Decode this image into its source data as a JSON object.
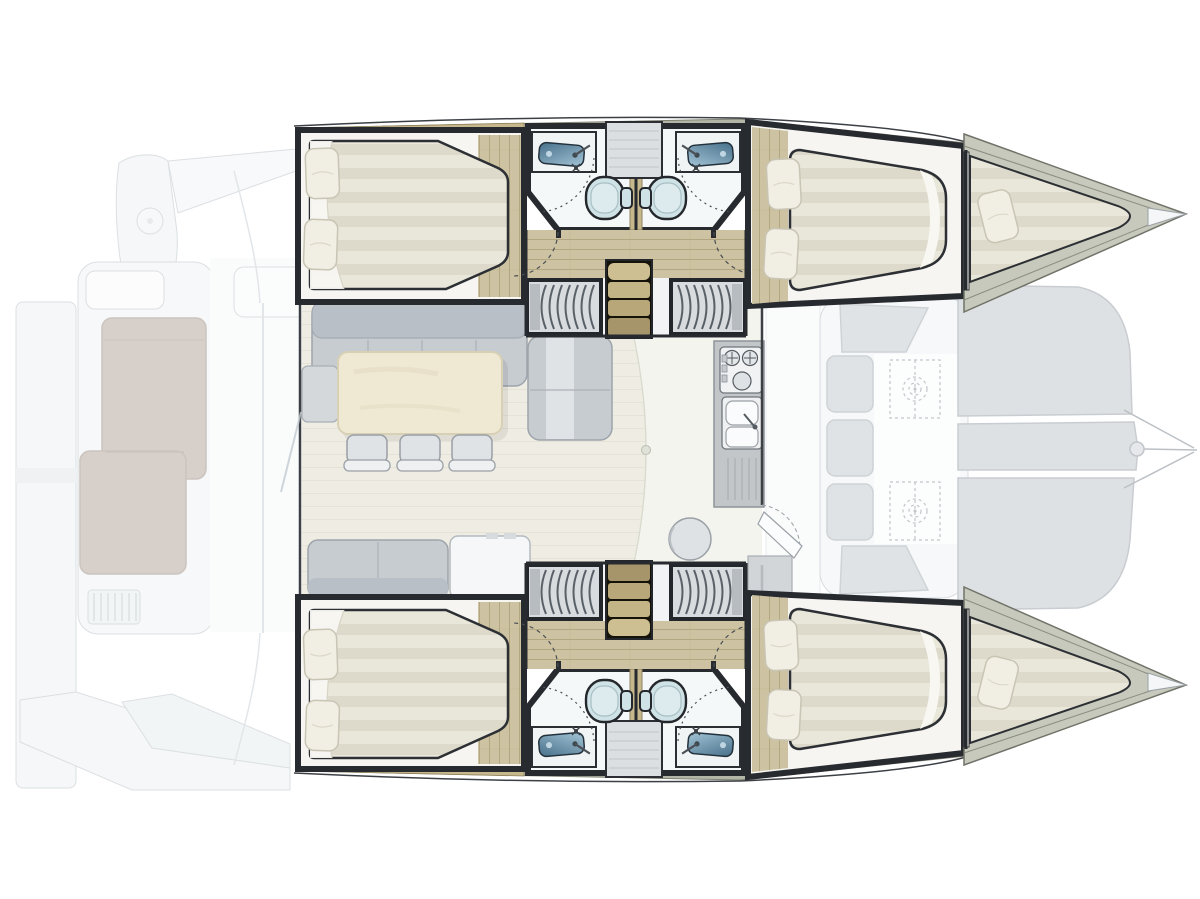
{
  "diagram": {
    "kind": "catamaran-interior-floor-plan",
    "orientation": {
      "bow": "right",
      "stern": "left",
      "port_hull": "top",
      "starboard_hull": "bottom"
    },
    "exterior": {
      "aft_deck_features": [
        "swim-platform",
        "transom-steps",
        "cockpit-lounge-l-sofa",
        "cockpit-bench",
        "deck-grille",
        "round-deck-fitting",
        "side-walkways",
        "sliding-door-track"
      ],
      "foredeck_features": [
        "forward-cockpit-bench",
        "seat-cushions",
        "deck-hatches-dashed",
        "trampoline-panels",
        "bowsprit-bridle-lines",
        "bridle-pin"
      ],
      "trampoline_panel_count": 3,
      "deck_hatch_count": 2
    },
    "port_hull": {
      "rooms": [
        {
          "name": "aft-cabin",
          "fixtures": [
            "double-berth",
            "pillow",
            "pillow",
            "sheet-fold",
            "wood-floor"
          ]
        },
        {
          "name": "aft-head",
          "fixtures": [
            "washbasin",
            "faucet",
            "toilet",
            "shower-door-arc",
            "shower-symbol"
          ]
        },
        {
          "name": "forward-head",
          "fixtures": [
            "washbasin",
            "faucet",
            "toilet",
            "shower-door-arc",
            "shower-symbol"
          ]
        },
        {
          "name": "vanity-cabinet",
          "fixtures": [
            "shelf-cabinet"
          ]
        },
        {
          "name": "companionway",
          "fixtures": [
            "stairs-4-steps",
            "hanging-locker-aft",
            "hanging-locker-forward",
            "door-swing-arc",
            "door-swing-arc"
          ]
        },
        {
          "name": "forward-cabin",
          "fixtures": [
            "double-berth",
            "pillow",
            "pillow",
            "wood-floor"
          ]
        },
        {
          "name": "forepeak",
          "fixtures": [
            "crew-berth",
            "pillow",
            "bow-deck",
            "bow-tip"
          ]
        }
      ]
    },
    "starboard_hull": {
      "mirror_of": "port_hull"
    },
    "salon": {
      "fixtures": [
        "l-shaped-sofa",
        "throw-blanket",
        "side-table",
        "dining-table",
        "dining-chair",
        "dining-chair",
        "dining-chair",
        "bench-seat",
        "storage-cabinet",
        "galley-counter",
        "stove-2-burner",
        "stove-knobs",
        "double-sink",
        "faucet",
        "drainboard",
        "round-stool",
        "foredeck-door-leaf",
        "aft-sliding-door",
        "roof-arc-line",
        "door-knob"
      ]
    },
    "counts": {
      "cabins": 4,
      "heads": 4,
      "forepeak_berths": 2,
      "dining_chairs": 3,
      "toilets": 4,
      "washbasins": 4,
      "hanging_lockers": 4,
      "stairways": 2
    }
  },
  "colors": {
    "paper": "#ffffff",
    "fade_fill": "#eef1f3",
    "fade_fill_2": "#e3e7ea",
    "fade_stroke": "#bfc7cd",
    "cushion": "#cdd2d7",
    "cushion_edge": "#aeb6bc",
    "taupe_sofa": "#b7a89f",
    "taupe_edge": "#a3948c",
    "trampoline": "#c9ced3",
    "trampoline_edge": "#a6adb3",
    "wall_dark": "#272a2f",
    "deck_band": "#b3b5a6",
    "deck_band_edge": "#7e8173",
    "wood_floor": "#cdc3a2",
    "wood_line": "#b2a781",
    "wood_trim": "#c6b88c",
    "bed_platform": "#f6f5f1",
    "mattress": "#e9e6da",
    "mattress_stripe": "#dedacb",
    "mattress_edge": "#2c2f33",
    "pillow": "#f1eee3",
    "pillow_edge": "#c9c5b4",
    "bath_floor": "#f5f8f9",
    "counter_white": "#f1f4f5",
    "sink_blue_deep": "#47708a",
    "sink_blue_light": "#a3c4d6",
    "toilet": "#cfe2e6",
    "locker_body": "#d8dcdf",
    "locker_stripe": "#596067",
    "stair_wood": "#c9ba8d",
    "stair_dark": "#151209",
    "salon_floor": "#efede3",
    "salon_floor_light": "#f3f4ee",
    "salon_plank": "#e3e0d4",
    "sofa_gray": "#c7ccd1",
    "sofa_gray_dark": "#b9bfc6",
    "sofa_edge": "#9da4ab",
    "table_cream": "#efe8d3",
    "table_edge": "#d8d0b4",
    "chair_fill": "#e0e3e6",
    "chair_edge": "#9aa0a6",
    "cabinet_white": "#f5f7f8",
    "galley_counter": "#c2c6c8",
    "arc_stroke": "#4a4f55"
  }
}
